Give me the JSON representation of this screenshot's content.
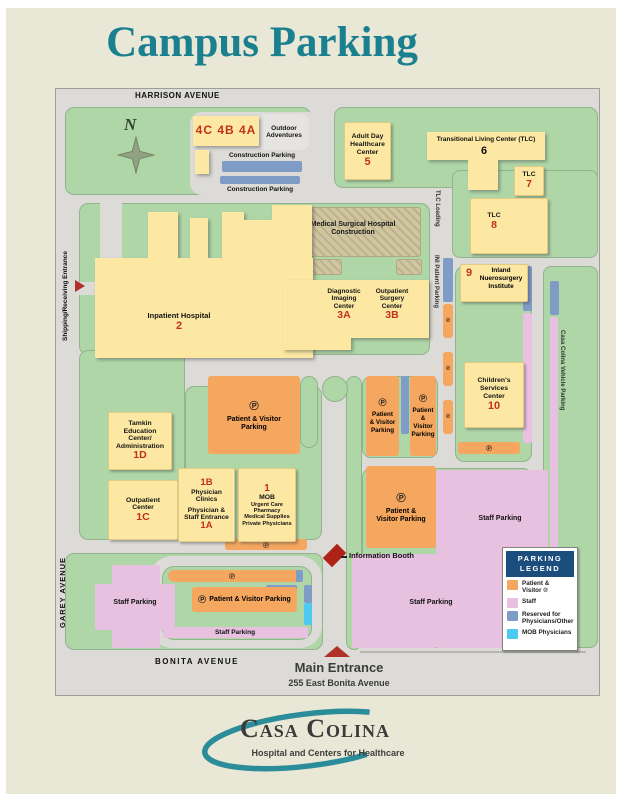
{
  "title": "Campus Parking",
  "streets": {
    "harrison": "HARRISON AVENUE",
    "garey": "GAREY AVENUE",
    "bonita": "BONITA AVENUE"
  },
  "vertical_labels": {
    "shipping": "Shipping/Receiving Entrance",
    "tlc_loading": "TLC Loading",
    "ini_parking": "INI Patient Parking",
    "cc_vehicle": "Casa Colina Vehicle Parking"
  },
  "compass_n": "N",
  "entrances": {
    "main_label": "Main Entrance",
    "main_address": "255 East Bonita Avenue",
    "info_booth": "Information Booth"
  },
  "buildings": {
    "b4": {
      "num": "4C 4B 4A",
      "label": "Outdoor Adventures"
    },
    "b5": {
      "name": "Adult Day Healthcare Center",
      "num": "5"
    },
    "b6": {
      "name": "Transitional Living Center (TLC)",
      "num": "6"
    },
    "b7": {
      "name": "TLC",
      "num": "7"
    },
    "b8": {
      "name": "TLC",
      "num": "8"
    },
    "construction": {
      "name": "Medical Surgical Hospital Construction"
    },
    "b2": {
      "name": "Inpatient Hospital",
      "num": "2"
    },
    "b3a": {
      "name": "Diagnostic Imaging Center",
      "num": "3A"
    },
    "b3b": {
      "name": "Outpatient Surgery Center",
      "num": "3B"
    },
    "b9": {
      "name": "Inland Nuerosurgery Institute",
      "num": "9"
    },
    "b10": {
      "name": "Children's Services Center",
      "num": "10"
    },
    "b1d": {
      "name": "Tamkin Education Center/ Administration",
      "num": "1D"
    },
    "b1c": {
      "name": "Outpatient Center",
      "num": "1C"
    },
    "b1b": {
      "name": "Physician Clinics",
      "num": "1B"
    },
    "b1a": {
      "name": "Physician & Staff Entrance",
      "num": "1A"
    },
    "b1": {
      "name": "MOB",
      "num": "1",
      "services": [
        "Urgent Care",
        "Pharmacy",
        "Medical Supplies",
        "Private Physicians"
      ]
    }
  },
  "parking": {
    "construction": "Construction Parking",
    "patient_visitor": "Patient & Visitor Parking",
    "staff": "Staff Parking",
    "p": "℗"
  },
  "legend": {
    "title": "PARKING LEGEND",
    "items": [
      {
        "label": "Patient & Visitor ℗",
        "color": "#f5a75f"
      },
      {
        "label": "Staff",
        "color": "#e8c1e1"
      },
      {
        "label": "Reserved for Physicians/Other",
        "color": "#7e9cc5"
      },
      {
        "label": "MOB Physicians",
        "color": "#4ec9f2"
      }
    ]
  },
  "logo": {
    "name": "Casa Colina",
    "tagline": "Hospital and Centers for Healthcare"
  },
  "colors": {
    "accent_teal": "#1a7f8e",
    "building_yellow": "#fce8a2",
    "patient_orange": "#f5a75f",
    "staff_pink": "#e8c1e1",
    "reserved_blue": "#7e9cc5",
    "mob_cyan": "#4ec9f2",
    "map_green": "#aed6a6",
    "entrance_red": "#b03227",
    "legend_navy": "#1c4e7d"
  }
}
